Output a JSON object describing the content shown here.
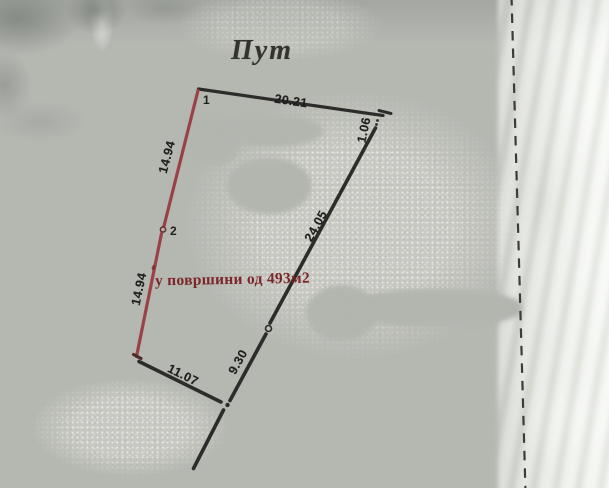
{
  "title": {
    "text": "Пут"
  },
  "area_note": {
    "text": "у површини од 493м2"
  },
  "points": [
    {
      "label": "1"
    },
    {
      "label": "2"
    }
  ],
  "measurements": {
    "road_frontage": "20.21",
    "corner_offset": "1.06",
    "east_side": "24.05",
    "west_side_upper": "14.94",
    "west_side_lower": "14.94",
    "south_side": "11.07",
    "southeast_side": "9.30"
  },
  "colors": {
    "paper": "#b5b7b1",
    "ink": "#2c2c2a",
    "measure-ink": "#1f1f1d",
    "parcel-red": "#9a4246",
    "annotation-red": "#7d2629",
    "title-ink": "#34342f",
    "dash": "#3c3c3a"
  }
}
